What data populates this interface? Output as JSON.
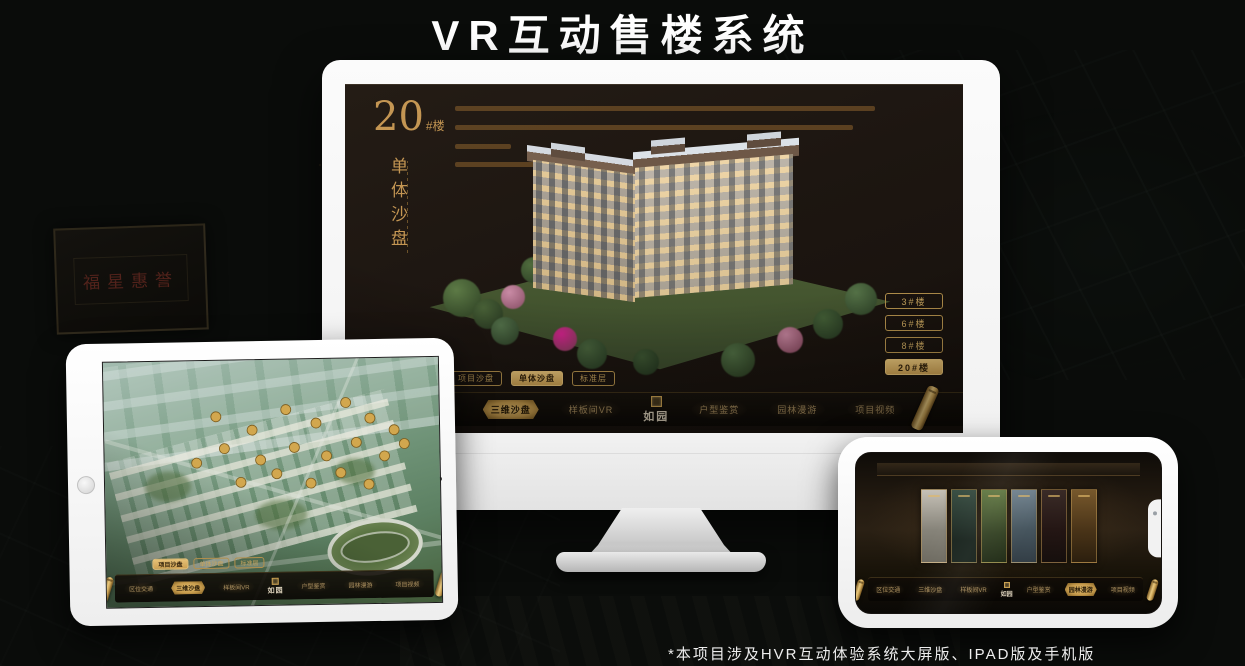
{
  "page": {
    "title": "VR互动售楼系统",
    "footnote": "*本项目涉及HVR互动体验系统大屏版、IPAD版及手机版"
  },
  "colors": {
    "gold": "#c8a55e",
    "gold_selected_fill": "#d9b469",
    "screen_bg": "#1d1611",
    "page_bg": "#0a0c0a",
    "plaque_red": "#a93e32"
  },
  "background": {
    "plaque_text": "福星惠誉"
  },
  "monitor": {
    "heading": {
      "number": "20",
      "suffix": "#楼",
      "subtitle": "单体沙盘"
    },
    "floor_buttons": [
      {
        "label": "3#楼",
        "selected": false
      },
      {
        "label": "6#楼",
        "selected": false
      },
      {
        "label": "8#楼",
        "selected": false
      },
      {
        "label": "20#楼",
        "selected": true
      }
    ],
    "sub_tabs": [
      {
        "label": "项目沙盘",
        "selected": false
      },
      {
        "label": "单体沙盘",
        "selected": true
      },
      {
        "label": "标准层",
        "selected": false
      }
    ],
    "nav": {
      "logo": "如园",
      "items": [
        {
          "label": "区位交通",
          "selected": false
        },
        {
          "label": "三维沙盘",
          "selected": true
        },
        {
          "label": "样板间VR",
          "selected": false
        },
        {
          "label": "户型鉴赏",
          "selected": false
        },
        {
          "label": "园林漫游",
          "selected": false
        },
        {
          "label": "项目视频",
          "selected": false
        }
      ]
    }
  },
  "tablet": {
    "sub_tabs": [
      {
        "label": "项目沙盘",
        "selected": true
      },
      {
        "label": "单体沙盘",
        "selected": false
      },
      {
        "label": "标准层",
        "selected": false
      }
    ],
    "nav": {
      "logo": "如园",
      "items": [
        {
          "label": "区位交通",
          "selected": false
        },
        {
          "label": "三维沙盘",
          "selected": true
        },
        {
          "label": "样板间VR",
          "selected": false
        },
        {
          "label": "户型鉴赏",
          "selected": false
        },
        {
          "label": "园林漫游",
          "selected": false
        },
        {
          "label": "项目视频",
          "selected": false
        }
      ]
    }
  },
  "phone": {
    "nav": {
      "logo": "如园",
      "items": [
        {
          "label": "区位交通",
          "selected": false
        },
        {
          "label": "三维沙盘",
          "selected": false
        },
        {
          "label": "样板间VR",
          "selected": false
        },
        {
          "label": "户型鉴赏",
          "selected": false
        },
        {
          "label": "园林漫游",
          "selected": true
        },
        {
          "label": "项目视频",
          "selected": false
        }
      ]
    }
  }
}
